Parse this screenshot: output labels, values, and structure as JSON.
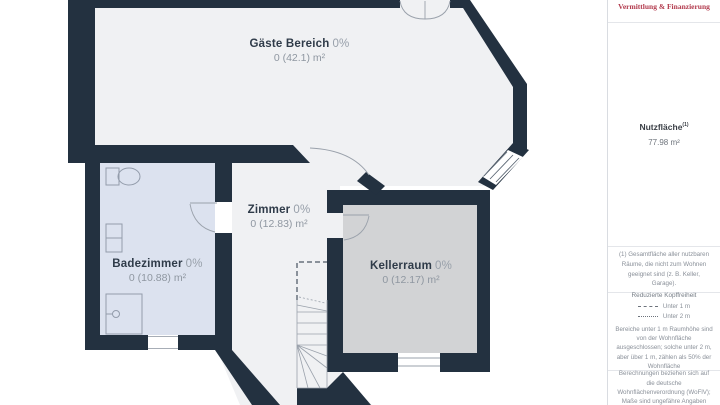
{
  "plan": {
    "rooms": [
      {
        "id": "gaeste",
        "name": "Gäste Bereich",
        "percent": "0%",
        "area": "0 (42.1) m²"
      },
      {
        "id": "zimmer",
        "name": "Zimmer",
        "percent": "0%",
        "area": "0 (12.83) m²"
      },
      {
        "id": "badezimmer",
        "name": "Badezimmer",
        "percent": "0%",
        "area": "0 (10.88) m²"
      },
      {
        "id": "kellerraum",
        "name": "Kellerraum",
        "percent": "0%",
        "area": "0 (12.17) m²"
      }
    ],
    "colors": {
      "wall": "#233140",
      "floor_default": "#f0f1f3",
      "floor_bath": "#dce2ef",
      "floor_cellar": "#d2d3d5"
    }
  },
  "sidebar": {
    "logo_text": "Vermittlung & Finanzierung",
    "summary": {
      "label": "Nutzfläche",
      "footnote_marker": "(1)",
      "value": "77.98 m²"
    },
    "footnote": "(1) Gesamtfläche aller nutzbaren Räume, die nicht zum Wohnen geeignet sind (z. B. Keller, Garage).",
    "headroom": {
      "title": "Reduzierte Kopffreiheit",
      "legend": [
        {
          "style": "dashed",
          "label": "Unter 1 m"
        },
        {
          "style": "dotted",
          "label": "Unter 2 m"
        }
      ],
      "description": "Bereiche unter 1 m Raumhöhe sind von der Wohnfläche ausgeschlossen; solche unter 2 m, aber über 1 m, zählen als 50% der Wohnfläche"
    },
    "disclaimer": "Berechnungen beziehen sich auf die deutsche Wohnflächenverordnung (WoFlV); Maße sind ungefähre Angaben"
  }
}
